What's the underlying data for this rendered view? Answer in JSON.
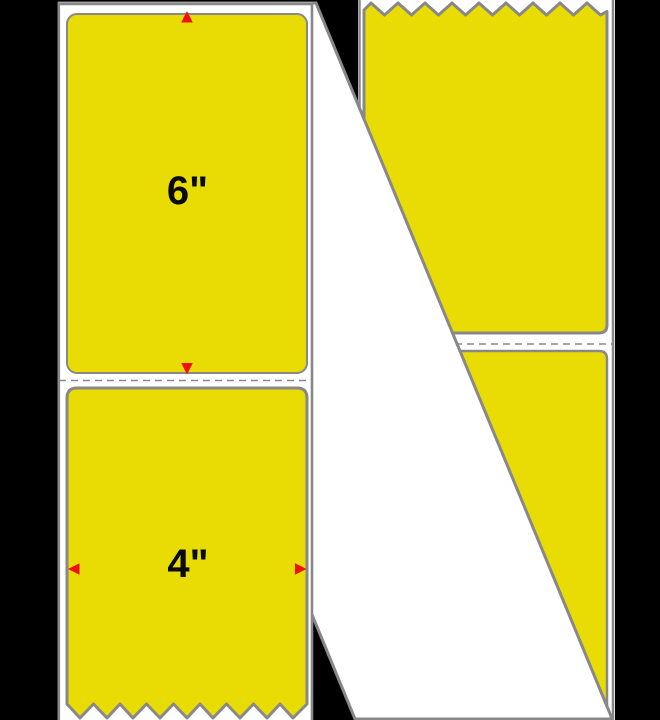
{
  "product_image": {
    "dimension_labels": {
      "height": "6\"",
      "width": "4\""
    }
  },
  "icons": {
    "arrow_up": "▲",
    "arrow_down": "▼",
    "arrow_left": "◀",
    "arrow_right": "▶"
  },
  "colors": {
    "background": "#000000",
    "label_yellow": "#e9dc05",
    "liner_white": "#ffffff",
    "border_gray": "#888888",
    "perforation_gray": "#8a8a8a",
    "arrow_red": "#f01010",
    "text_black": "#0a0a0a"
  }
}
